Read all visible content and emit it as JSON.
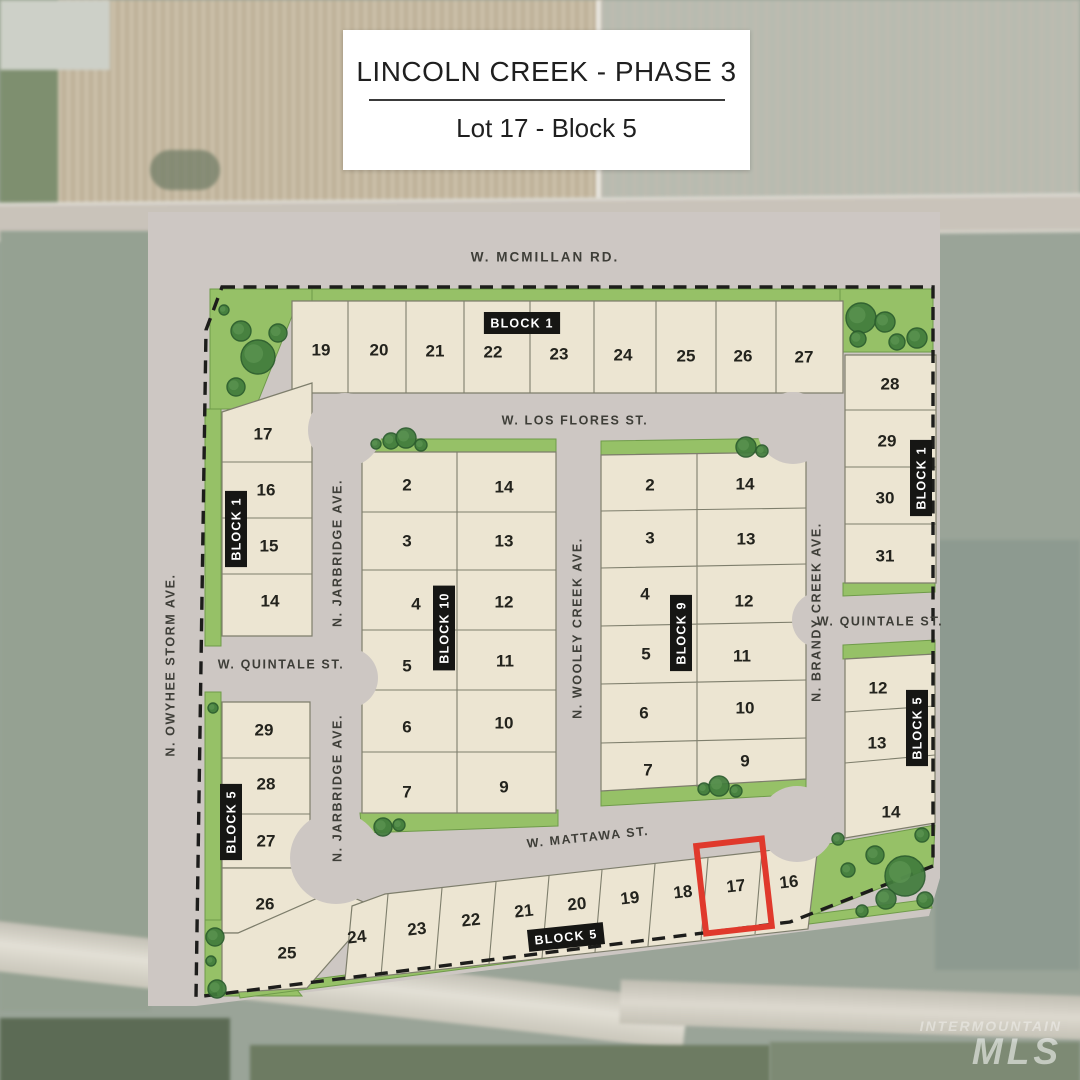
{
  "flyer": {
    "title": "LINCOLN CREEK - PHASE 3",
    "subtitle": "Lot 17 - Block 5"
  },
  "watermark": {
    "line1": "INTERMOUNTAIN",
    "line2": "MLS"
  },
  "colors": {
    "lot_fill": "#ece5d2",
    "lot_stroke": "#7e7e6c",
    "road_gray": "#cdc7c3",
    "green": "#96c167",
    "green_stroke": "#6f9b4a",
    "tree_fill": "#417c3c",
    "tree_stroke": "#2a5c2d",
    "boundary_dash": "#1d1d1b",
    "tag_bg": "#161614",
    "tag_text": "#ffffff",
    "street_text": "#3e3e38",
    "lot_text": "#23231d",
    "highlight": "#e0392c"
  },
  "plat": {
    "streets": [
      {
        "id": "mcmillan",
        "label": "W. MCMILLAN RD.",
        "x": 545,
        "y": 258,
        "rotate": 0,
        "size": "lg"
      },
      {
        "id": "los-flores",
        "label": "W. LOS FLORES ST.",
        "x": 575,
        "y": 421,
        "rotate": 0
      },
      {
        "id": "quintale-west",
        "label": "W. QUINTALE ST.",
        "x": 281,
        "y": 665,
        "rotate": 0
      },
      {
        "id": "quintale-east",
        "label": "W. QUINTALE ST.",
        "x": 880,
        "y": 622,
        "rotate": 0
      },
      {
        "id": "mattawa",
        "label": "W. MATTAWA ST.",
        "x": 588,
        "y": 838,
        "rotate": -6
      },
      {
        "id": "jarbridge-north",
        "label": "N. JARBRIDGE AVE.",
        "x": 338,
        "y": 553,
        "rotate": -90
      },
      {
        "id": "jarbridge-south",
        "label": "N. JARBRIDGE AVE.",
        "x": 338,
        "y": 788,
        "rotate": -90
      },
      {
        "id": "wooley-creek",
        "label": "N. WOOLEY CREEK AVE.",
        "x": 578,
        "y": 628,
        "rotate": -90
      },
      {
        "id": "brandy-creek",
        "label": "N. BRANDY CREEK AVE.",
        "x": 817,
        "y": 612,
        "rotate": -90
      },
      {
        "id": "owyhee-storm",
        "label": "N. OWYHEE STORM AVE.",
        "x": 171,
        "y": 665,
        "rotate": -90
      }
    ],
    "block_tags": [
      {
        "label": "BLOCK 1",
        "x": 522,
        "y": 323,
        "rotate": 0
      },
      {
        "label": "BLOCK 1",
        "x": 236,
        "y": 529,
        "rotate": -90
      },
      {
        "label": "BLOCK 1",
        "x": 921,
        "y": 478,
        "rotate": -90
      },
      {
        "label": "BLOCK 10",
        "x": 444,
        "y": 628,
        "rotate": -90
      },
      {
        "label": "BLOCK 9",
        "x": 681,
        "y": 633,
        "rotate": -90
      },
      {
        "label": "BLOCK 5",
        "x": 231,
        "y": 822,
        "rotate": -90
      },
      {
        "label": "BLOCK 5",
        "x": 917,
        "y": 728,
        "rotate": -90
      },
      {
        "label": "BLOCK 5",
        "x": 566,
        "y": 937,
        "rotate": -6
      }
    ],
    "lots": [
      {
        "n": "19",
        "x": 321,
        "y": 351
      },
      {
        "n": "20",
        "x": 379,
        "y": 351
      },
      {
        "n": "21",
        "x": 435,
        "y": 352
      },
      {
        "n": "22",
        "x": 493,
        "y": 353
      },
      {
        "n": "23",
        "x": 559,
        "y": 355
      },
      {
        "n": "24",
        "x": 623,
        "y": 356
      },
      {
        "n": "25",
        "x": 686,
        "y": 357
      },
      {
        "n": "26",
        "x": 743,
        "y": 357
      },
      {
        "n": "27",
        "x": 804,
        "y": 358
      },
      {
        "n": "28",
        "x": 890,
        "y": 385
      },
      {
        "n": "29",
        "x": 887,
        "y": 442
      },
      {
        "n": "30",
        "x": 885,
        "y": 499
      },
      {
        "n": "31",
        "x": 885,
        "y": 557
      },
      {
        "n": "17",
        "x": 263,
        "y": 435
      },
      {
        "n": "16",
        "x": 266,
        "y": 491
      },
      {
        "n": "15",
        "x": 269,
        "y": 547
      },
      {
        "n": "14",
        "x": 270,
        "y": 602
      },
      {
        "n": "2",
        "x": 407,
        "y": 486
      },
      {
        "n": "3",
        "x": 407,
        "y": 542
      },
      {
        "n": "4",
        "x": 416,
        "y": 605
      },
      {
        "n": "5",
        "x": 407,
        "y": 667
      },
      {
        "n": "6",
        "x": 407,
        "y": 728
      },
      {
        "n": "7",
        "x": 407,
        "y": 793
      },
      {
        "n": "14",
        "x": 504,
        "y": 488
      },
      {
        "n": "13",
        "x": 504,
        "y": 542
      },
      {
        "n": "12",
        "x": 504,
        "y": 603
      },
      {
        "n": "11",
        "x": 505,
        "y": 662
      },
      {
        "n": "10",
        "x": 504,
        "y": 724
      },
      {
        "n": "9",
        "x": 504,
        "y": 788
      },
      {
        "n": "2",
        "x": 650,
        "y": 486
      },
      {
        "n": "3",
        "x": 650,
        "y": 539
      },
      {
        "n": "4",
        "x": 645,
        "y": 595
      },
      {
        "n": "5",
        "x": 646,
        "y": 655
      },
      {
        "n": "6",
        "x": 644,
        "y": 714
      },
      {
        "n": "7",
        "x": 648,
        "y": 771
      },
      {
        "n": "14",
        "x": 745,
        "y": 485
      },
      {
        "n": "13",
        "x": 746,
        "y": 540
      },
      {
        "n": "12",
        "x": 744,
        "y": 602
      },
      {
        "n": "11",
        "x": 742,
        "y": 657
      },
      {
        "n": "10",
        "x": 745,
        "y": 709
      },
      {
        "n": "9",
        "x": 745,
        "y": 762
      },
      {
        "n": "12",
        "x": 878,
        "y": 689
      },
      {
        "n": "13",
        "x": 877,
        "y": 744
      },
      {
        "n": "14",
        "x": 891,
        "y": 813
      },
      {
        "n": "29",
        "x": 264,
        "y": 731
      },
      {
        "n": "28",
        "x": 266,
        "y": 785
      },
      {
        "n": "27",
        "x": 266,
        "y": 842
      },
      {
        "n": "26",
        "x": 265,
        "y": 905
      },
      {
        "n": "25",
        "x": 287,
        "y": 954
      },
      {
        "n": "24",
        "x": 357,
        "y": 938,
        "r": -6
      },
      {
        "n": "23",
        "x": 417,
        "y": 930,
        "r": -6
      },
      {
        "n": "22",
        "x": 471,
        "y": 921,
        "r": -6
      },
      {
        "n": "21",
        "x": 524,
        "y": 912,
        "r": -6
      },
      {
        "n": "20",
        "x": 577,
        "y": 905,
        "r": -6
      },
      {
        "n": "19",
        "x": 630,
        "y": 899,
        "r": -6
      },
      {
        "n": "18",
        "x": 683,
        "y": 893,
        "r": -6
      },
      {
        "n": "17",
        "x": 736,
        "y": 887,
        "r": -6
      },
      {
        "n": "16",
        "x": 789,
        "y": 883,
        "r": -6
      }
    ],
    "trees": [
      [
        258,
        357,
        17
      ],
      [
        241,
        331,
        10
      ],
      [
        278,
        333,
        9
      ],
      [
        236,
        387,
        9
      ],
      [
        224,
        310,
        5
      ],
      [
        861,
        318,
        15
      ],
      [
        885,
        322,
        10
      ],
      [
        858,
        339,
        8
      ],
      [
        897,
        342,
        8
      ],
      [
        917,
        338,
        10
      ],
      [
        391,
        441,
        8
      ],
      [
        406,
        438,
        10
      ],
      [
        421,
        445,
        6
      ],
      [
        376,
        444,
        5
      ],
      [
        383,
        827,
        9
      ],
      [
        399,
        825,
        6
      ],
      [
        746,
        447,
        10
      ],
      [
        762,
        451,
        6
      ],
      [
        704,
        789,
        6
      ],
      [
        719,
        786,
        10
      ],
      [
        736,
        791,
        6
      ],
      [
        213,
        708,
        5
      ],
      [
        215,
        937,
        9
      ],
      [
        211,
        961,
        5
      ],
      [
        217,
        989,
        9
      ],
      [
        905,
        876,
        20
      ],
      [
        875,
        855,
        9
      ],
      [
        886,
        899,
        10
      ],
      [
        848,
        870,
        7
      ],
      [
        925,
        900,
        8
      ],
      [
        838,
        839,
        6
      ],
      [
        922,
        835,
        7
      ],
      [
        862,
        911,
        6
      ]
    ],
    "highlight": {
      "lot": "17",
      "cx": 734,
      "cy": 886,
      "w": 66,
      "h": 88,
      "rotate": -6.5
    }
  }
}
